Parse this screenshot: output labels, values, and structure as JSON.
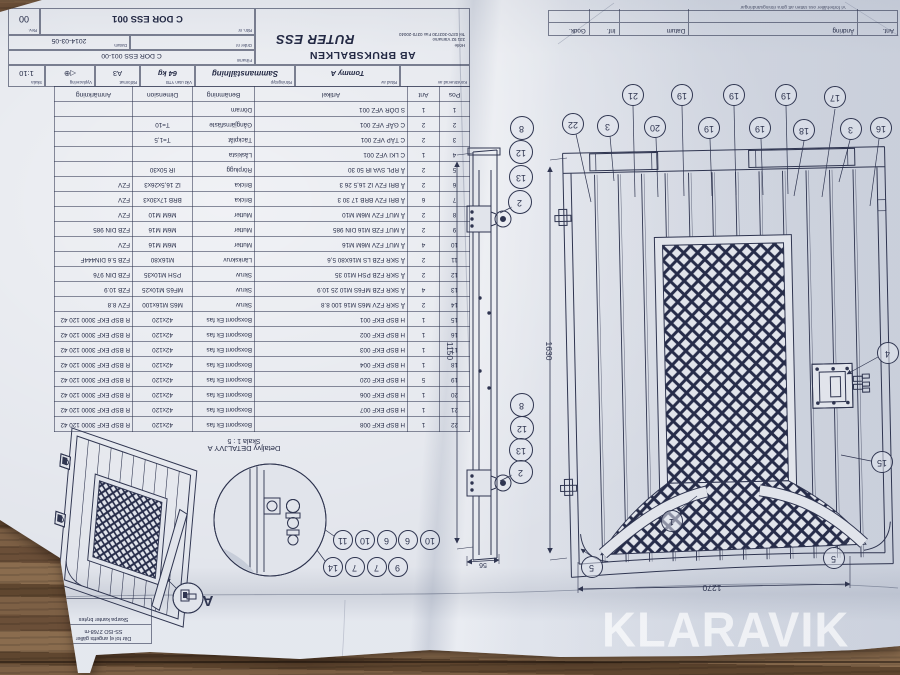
{
  "watermark": "KLARAVIK",
  "colors": {
    "ink": "#2f3550",
    "paper": "#e1e4eb",
    "wood": "#6b4f38"
  },
  "title_block": {
    "company": "AB BRUKSBALKEN",
    "address1": "Hörle",
    "address2": "331 92 Värnamo",
    "address3": "Tel 0370-303730 Fax 0370-20040",
    "drawing_title": "RUTER ESS",
    "designed_label": "Konstruerad av",
    "drawn_label": "Ritad av",
    "drawn_by": "Tommy A",
    "type_label": "Ritningstyp",
    "type_value": "Sammanställning",
    "weight_label": "Vikt utan YTB",
    "weight_value": "64 kg",
    "format_label": "Ritformat",
    "format_value": "A3",
    "view_label": "Vyplacering",
    "view_symbol": "◁⊕",
    "scale_label": "Skala",
    "scale_value": "1:10",
    "filename_label": "Filnamn",
    "filename_value": "C DOR ESS 001-00",
    "order_label": "Order nr",
    "date_label": "Datum",
    "date_value": "2014-03-05",
    "drawing_no_label": "Ritn. nr",
    "drawing_no": "C DOR ESS 001",
    "rev_label": "Rev.",
    "rev_value": "00"
  },
  "revision_table": {
    "headers": [
      "Ant.",
      "Ändring",
      "Datum",
      "Inf.",
      "Godk."
    ],
    "note": "Vi förbehåller oss rätten att göra ritningsändringar"
  },
  "parts_table": {
    "headers": [
      "Pos",
      "Ant",
      "Artikel",
      "Benämning",
      "Dimension",
      "Anmärkning"
    ],
    "rows": [
      [
        "1",
        "1",
        "S DÖR VFZ 001",
        "Dörram",
        "",
        ""
      ],
      [
        "2",
        "2",
        "C GÅF VFZ 001",
        "Gångjärnsfäste",
        "T=10",
        ""
      ],
      [
        "3",
        "2",
        "C TÄP VFZ 001",
        "Täckplåt",
        "T=1,5",
        ""
      ],
      [
        "4",
        "1",
        "C LKI VFZ 001",
        "Låskista",
        "",
        ""
      ],
      [
        "5",
        "2",
        "Å RPL SVA IR 50 30",
        "Rörplugg",
        "IR 50x30",
        ""
      ],
      [
        "6",
        "2",
        "Å BRI FZV IZ 16,5 26 3",
        "Bricka",
        "IZ 16,5x26x3",
        "FZV"
      ],
      [
        "7",
        "6",
        "Å BRI FZV BRB 17 30 3",
        "Bricka",
        "BRB 17x30x3",
        "FZV"
      ],
      [
        "8",
        "2",
        "Å MUT FZV M6M M10",
        "Mutter",
        "M6M M10",
        "FZV"
      ],
      [
        "9",
        "2",
        "Å MUT FZB M16 DIN 985",
        "Mutter",
        "M6M M16",
        "FZB DIN 985"
      ],
      [
        "10",
        "4",
        "Å MUT FZV M6M M16",
        "Mutter",
        "M6M M16",
        "FZV"
      ],
      [
        "11",
        "2",
        "Å SKR FZB LS M16X80 5,6",
        "Länkskruv",
        "M16X80",
        "FZB 5.6 DIN444F"
      ],
      [
        "12",
        "2",
        "Å SKR FZB PSH M10 35",
        "Skruv",
        "PSH M10x35",
        "FZB DIN 976"
      ],
      [
        "13",
        "4",
        "Å SKR FZB MF6S M10 25 10.9",
        "Skruv",
        "MF6S M10x25",
        "FZB 10.9"
      ],
      [
        "14",
        "2",
        "Å SKR FZV M6S M16 100 8.8",
        "Skruv",
        "M6S M16x100",
        "FZV 8.8"
      ],
      [
        "15",
        "1",
        "H BSP EKF 001",
        "Boxspont Ek fas",
        "42x120",
        "R BSP EKF 3000 120 42"
      ],
      [
        "16",
        "1",
        "H BSP EKF 002",
        "Boxspont Ek fas",
        "42x120",
        "R BSP EKF 3000 120 42"
      ],
      [
        "17",
        "1",
        "H BSP EKF 003",
        "Boxspont Ek fas",
        "42x120",
        "R BSP EKF 3000 120 42"
      ],
      [
        "18",
        "1",
        "H BSP EKF 004",
        "Boxspont Ek fas",
        "42x120",
        "R BSP EKF 3000 120 42"
      ],
      [
        "19",
        "5",
        "H BSP EKF 020",
        "Boxspont Ek fas",
        "42x120",
        "R BSP EKF 3000 120 42"
      ],
      [
        "20",
        "1",
        "H BSP EKF 006",
        "Boxspont Ek fas",
        "42x120",
        "R BSP EKF 3000 120 42"
      ],
      [
        "21",
        "1",
        "H BSP EKF 007",
        "Boxspont Ek fas",
        "42x120",
        "R BSP EKF 3000 120 42"
      ],
      [
        "22",
        "1",
        "H BSP EKF 008",
        "Boxspont Ek fas",
        "42x120",
        "R BSP EKF 3000 120 42"
      ]
    ]
  },
  "callouts": {
    "gate_top_upper": [
      "21",
      "19",
      "19",
      "19",
      "17"
    ],
    "gate_top_lower": [
      "22",
      "3",
      "20",
      "19",
      "19",
      "18",
      "3",
      "16"
    ],
    "hinge_stack_upper": [
      "8",
      "12",
      "13",
      "2"
    ],
    "hinge_stack_lower": [
      "8",
      "12",
      "13",
      "2"
    ],
    "gate_misc": [
      "1",
      "5",
      "5",
      "4",
      "15"
    ],
    "detail_upper": [
      "11",
      "10",
      "6",
      "6",
      "10"
    ],
    "detail_lower": [
      "14",
      "7",
      "7",
      "9"
    ]
  },
  "dimensions": {
    "gate_height": "1630",
    "leaf_height": "1150",
    "gate_width": "1270",
    "post_width": "56"
  },
  "notes": {
    "detail_title": "Detaljvy DETALJVY A",
    "detail_scale": "Skala 1 : 5",
    "tolerance_line1": "Där tol ej angetts gäller",
    "tolerance_line2": "SS-ISO 2768-m",
    "edge_note": "Skarpa kanter brytes",
    "view_marker": "A"
  }
}
